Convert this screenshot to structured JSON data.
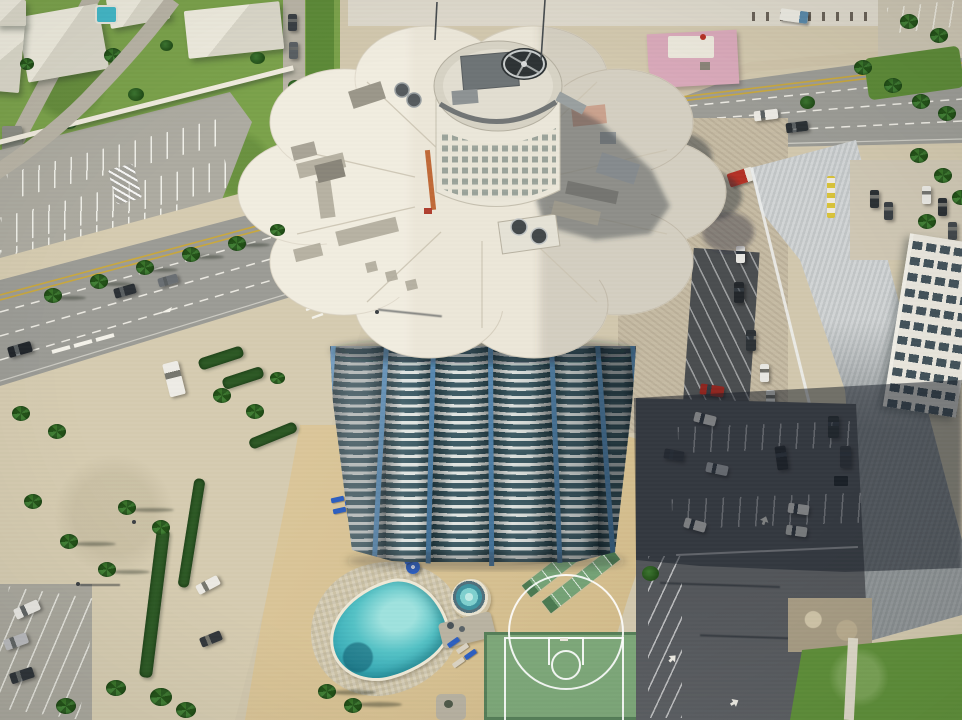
{
  "meta": {
    "domain": "aerial-drone-photograph",
    "description": "Aerial drone view looking down on a cylindrical beachfront condominium tower with a white scalloped flower-petal roof and round rooftop mechanical penthouse. Below the tower is a tan pool deck with a kidney-shaped pool, round spa, two shuffleboard courts, lounge chairs and a green basketball half-court. A multi-lane palm-lined coastal avenue runs diagonally past the property; residential homes with white roofs sit to the northwest behind a white wall, surface parking lots flank the tower, and commercial buildings with long gray metal roofs sit to the east, partially covered by the tower's cast shadow.",
    "visible_text": "none"
  },
  "palette": {
    "concrete": "#d2c8ae",
    "sand": "#d6ccb1",
    "grass": "#7ba24b",
    "grassDark": "#5d8a38",
    "lawn": "#5f8f3a",
    "roadAsphalt": "#9c9c96",
    "lotGray": "#adaba1",
    "deckTan": "#d8c190",
    "roofWhite": "#ece7d9",
    "roofShade": "#d9d2c0",
    "towerGlass": "#30505a",
    "towerBand": "#dfe3e0",
    "mullBlue": "#4d7fa8",
    "poolAqua": "#55c2c6",
    "poolDeep": "#2f9fae",
    "loungerBlue": "#2d5fc0",
    "courtGreen": "#7da779",
    "shuffleGreen": "#75a276",
    "asphaltDark": "#55585c",
    "shadowDark": "rgba(24,31,41,0.52)",
    "metalLit": "#c9cdce",
    "metalShade": "#83898c",
    "pink": "#d9a9ba",
    "dirt": "#c8bba0",
    "gravel": "#c6bba4",
    "hedge": "#2e5a26",
    "wallWhite": "#f1ecdf",
    "condoFace": "#e9e6dd",
    "condoWin": "#44535b",
    "yellowLine": "#c9a83e",
    "white": "#f2f0e8"
  },
  "scene": {
    "tower": {
      "name": "cylindrical-condo-tower",
      "roof": "white scalloped roof with 10 petals",
      "penthouse": "round mechanical penthouse, window grid, large exhaust fan, HVAC units, gray painted walkways, orange ladder",
      "balcony_floors_visible": 26,
      "facade_lobes": 6,
      "mullions": "steel-blue vertical dividers"
    },
    "amenities": [
      {
        "name": "kidney-shaped-pool",
        "water": "turquoise",
        "border": "checkered tile apron"
      },
      {
        "name": "round-spa"
      },
      {
        "name": "shuffleboard-courts",
        "count": 2
      },
      {
        "name": "basketball-half-court",
        "surface": "green with white lines"
      },
      {
        "name": "lounge-chairs",
        "count": 14,
        "color": "blue"
      },
      {
        "name": "pool-umbrella",
        "color": "blue"
      }
    ],
    "roads": [
      {
        "name": "coastal-avenue",
        "direction": "diagonal across frame",
        "lanes_visible": 4,
        "markings": [
          "double-yellow-center-line",
          "white-dashed-lane-lines",
          "left-turn-arrow",
          "stop-bars",
          "crosswalk-ticks"
        ]
      },
      {
        "name": "residential-street"
      },
      {
        "name": "side-street"
      }
    ],
    "buildings": [
      {
        "name": "residential-houses",
        "count": 6,
        "roofs": "white hip roofs"
      },
      {
        "name": "backyard-pool",
        "color": "aqua"
      },
      {
        "name": "pink-commercial-building"
      },
      {
        "name": "white-arched-pavilion"
      },
      {
        "name": "metal-roof-commercial-building",
        "roof": "long gray standing-seam"
      },
      {
        "name": "white-condo-slab",
        "windows": "dark grid"
      }
    ],
    "vehicles": {
      "on_road": 5,
      "parked": 24,
      "colors": [
        "white",
        "silver",
        "dark",
        "red",
        "maroon"
      ]
    },
    "vegetation": {
      "palm_trees": 32,
      "hedges": 8,
      "lawns": 4
    },
    "lighting": {
      "sun_direction": "west",
      "cast_shadows": [
        "tower-shadow-to-east",
        "roof-scallop-ground-shadow",
        "penthouse-shadow-on-roof",
        "palm-shadows"
      ]
    }
  }
}
